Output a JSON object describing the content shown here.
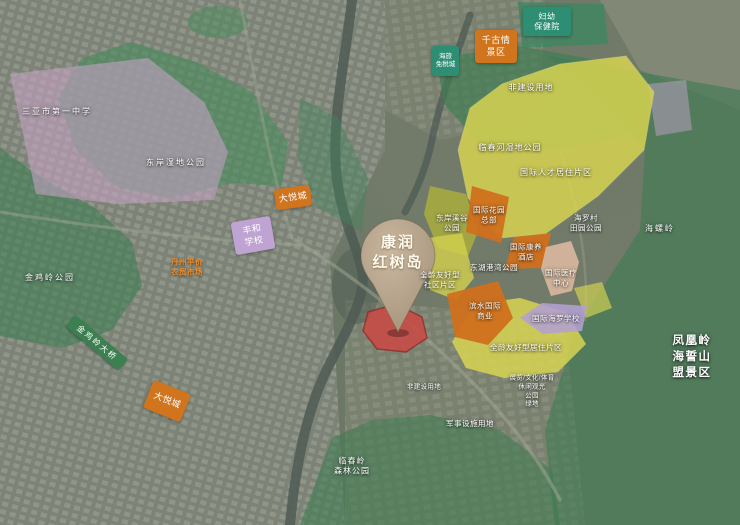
{
  "pin": {
    "label": "康润\n红树岛"
  },
  "signs": {
    "bridge": "金鸡岭大桥"
  },
  "labels": {
    "school_no1": "三亚市第一中学",
    "dongan_wetland_park": "东岸湿地公园",
    "jinjiling_park": "金鸡岭公园",
    "danzhou_market": "丹州平价\n农贸市场",
    "dayuecheng_1": "大悦城",
    "fenghe_school": "丰和\n学校",
    "dayuecheng_2": "大悦城",
    "fuyou_hospital": "妇幼\n保健院",
    "qianguqing": "千古情\n景区",
    "hailv_dutyfree": "海旅\n免税城",
    "feijianshe_1": "非建设用地",
    "linchunhe_park": "临春河湿地公园",
    "talent_district": "国际人才居住片区",
    "dongan_xigu_park": "东岸溪谷\n公园",
    "intl_garden_hq": "国际花园\n总部",
    "intl_kangyang_hotel": "国际康养\n酒店",
    "donghu_gangwan_park": "东湖港湾公园",
    "intl_medical_center": "国际医疗\n中心",
    "binshui_commerce": "滨水国际\n商业",
    "intl_hailuo_school": "国际海罗学校",
    "quanling_residential": "全龄友好型居住片区",
    "quanling_community": "全龄友好型\n社区片区",
    "hailuocun_park": "海罗村\n田园公园",
    "hailing_ridge": "海螺岭",
    "fenghuangling": "凤凰岭\n海誓山盟景区",
    "military_land": "军事设施用地",
    "zhanlan_land": "展览/文化/体育\n休闲观光\n公园\n绿地",
    "feijianshe_2": "非建设用地",
    "linchunling_park": "临春岭\n森林公园"
  },
  "colors": {
    "zone_yellow": "#d7d351",
    "zone_olive": "#a9ad3e",
    "zone_orange": "#d0741d",
    "zone_purple": "#cba4cb",
    "zone_red_site": "#c94a46",
    "park_green": "#3d7c51",
    "box_teal": "#2e8e74",
    "pin_tan": "#b5a289",
    "road_sign_green": "#3c7f51"
  }
}
